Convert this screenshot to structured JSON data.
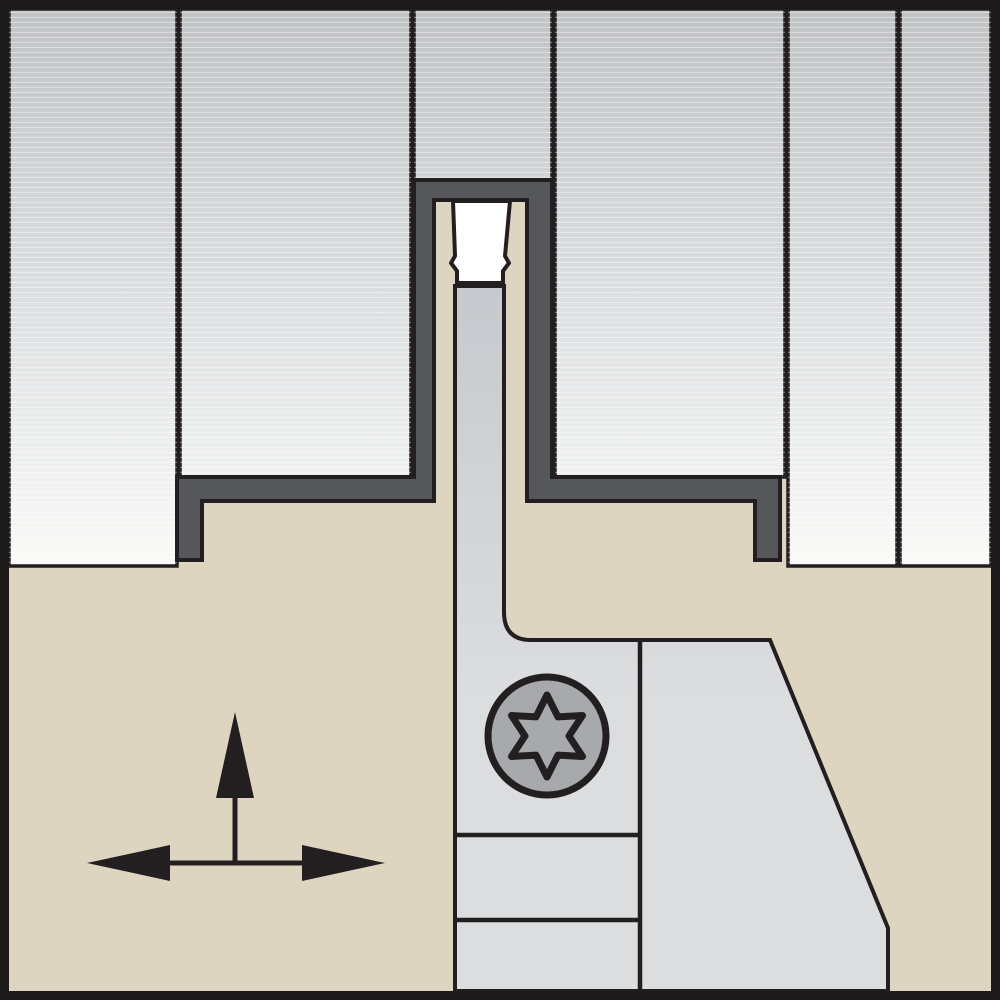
{
  "diagram": {
    "kind": "tool-cross-section-illustration",
    "subject": "grooving-cutoff-toolholder-in-workpiece",
    "workpiece_section_count": 6,
    "screw_drive": "torx-6-lobe",
    "arrows": {
      "vertical_direction": "up",
      "horizontal_direction": "left-right"
    }
  },
  "colors": {
    "outline": "#231f20",
    "frame": "#1d1a1b",
    "workpiece_top": "#c1c2c4",
    "workpiece_mid": "#dfe0e1",
    "workpiece_bottom": "#fafaf9",
    "stria": "#ffffff",
    "groove": "#56575a",
    "holder": "#ded5c1",
    "insert": "#ffffff",
    "blade_top": "#c6c9cd",
    "blade_bottom": "#dcddde",
    "screw_head": "#a7a9ac",
    "arrow": "#231f20"
  }
}
